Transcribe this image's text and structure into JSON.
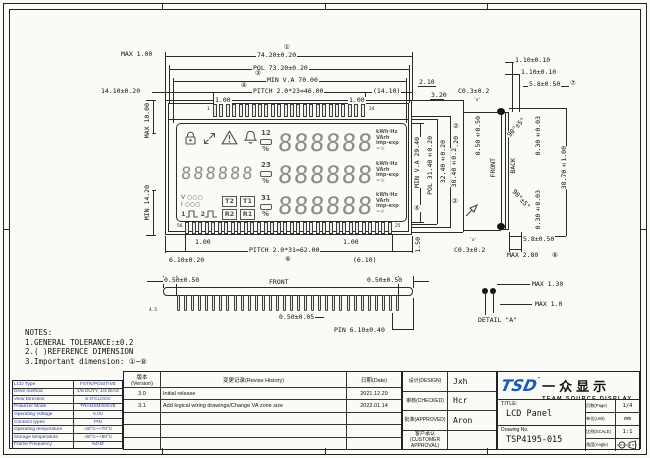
{
  "sheet": {
    "paper": "#fafaf7",
    "line": "#2a2a2a",
    "accent_blue": "#1a5cb5",
    "table_blue": "#2a3f9f"
  },
  "circles": {
    "c1": "①",
    "c2": "②",
    "c3": "③",
    "c4": "④",
    "c5": "⑤",
    "c6": "⑥",
    "c7": "⑦",
    "c8": "⑧"
  },
  "notes": {
    "lines": [
      "NOTES:",
      "1.GENERAL TOLERANCE:±0.2",
      "2.( )REFERENCE DIMENSION",
      "3.Important dimension: ①~⑧"
    ]
  },
  "top_view": {
    "dims": {
      "max_h": "MAX 1.00",
      "d74": "74.20±0.20",
      "pol73": "POL 73.20±0.20",
      "va70": "MIN V.A 70.00",
      "pitch46": "PITCH 2.0*23=46.00",
      "off1410": "14.10±0.20",
      "ref1410": "(14.10)",
      "g100a": "1.00",
      "g100b": "1.00",
      "m210": "2.10",
      "m320": "3.20",
      "max10": "MAX 10.00",
      "min142": "MIN 14.20",
      "va294": "MIN V.A 29.40",
      "pol314": "POL 31.40±0.20",
      "d324": "32.40±0.20",
      "d384": "38.40±0.20",
      "b100a": "1.00",
      "b100b": "1.00",
      "pitch62": "PITCH 2.0*31=62.00",
      "off610": "6.10±0.20",
      "ref610": "(6.10)",
      "m150": "1.50"
    },
    "pins": {
      "top_count": 24,
      "bottom_count": 32,
      "top_first": "1",
      "top_last": "24",
      "bottom_left": "56",
      "bottom_right": "25"
    }
  },
  "lcd": {
    "digits": "888888",
    "small_digits": "888888",
    "zones": [
      "12",
      "23",
      "31"
    ],
    "percent": "%",
    "boxes": [
      "T2",
      "T1",
      "R2",
      "R1"
    ],
    "left_legend": [
      "V ○○○",
      "I ○○○"
    ],
    "wave_labels": [
      "1",
      "2"
    ],
    "units_lines": [
      "kWh·Hz",
      "VArh",
      "imp-exp",
      "~☼"
    ]
  },
  "side_view": {
    "dims": {
      "t110a": "1.10±0.10",
      "t110b": "1.10±0.10",
      "t58": "5.8±0.50",
      "c03t": "C0.3±0.2",
      "xt": "'x'",
      "ang_t": "90°±5°",
      "v050": "0.50±0.50",
      "v030t": "0.30±0.03",
      "d384": "38.40±0.2",
      "d387": "38.70±1.00",
      "front": "FRONT",
      "back": "BACK",
      "ang_b": "90°±5°",
      "v030b": "0.30±0.03",
      "b58": "5.8±0.50",
      "max28": "MAX 2.80",
      "c03b": "C0.3±0.2",
      "xb": "'x'"
    }
  },
  "front_view": {
    "dims": {
      "l050": "0.50±0.50",
      "label": "FRONT",
      "r050": "0.50±0.50",
      "t005": "0.50±0.05",
      "pin610": "PIN 6.10±0.40",
      "a45": "4.5"
    },
    "pin_count": 32
  },
  "detail_a": {
    "max130": "MAX 1.30",
    "max10": "MAX 1.0",
    "label": "DETAIL \"A\""
  },
  "spec_table": {
    "rows": [
      [
        "LCD Type",
        "FSTN/POSITIVE"
      ],
      [
        "Drive method",
        "1/8 DUTY, 1/4 BIAS"
      ],
      [
        "View Direction",
        "6 O'CLOCK"
      ],
      [
        "Polarizer Mode",
        "TRANSMISSIVE"
      ],
      [
        "Operating Voltage",
        "5.0V"
      ],
      [
        "Connect types",
        "PIN"
      ],
      [
        "Operating temperature",
        "-20°C~+70°C"
      ],
      [
        "Storage temperature",
        "-30°C~+80°C"
      ],
      [
        "Frame Frequency",
        "64HZ"
      ]
    ]
  },
  "revision_table": {
    "headers": [
      "版本(Version)",
      "变更记录(Revise History)",
      "日期(Date)"
    ],
    "rows": [
      [
        "3.0",
        "Initial release",
        "2021.12.29"
      ],
      [
        "3.1",
        "Add logical wiring drawings/Change VA zone size",
        "2022.01.14"
      ],
      [
        "",
        "",
        ""
      ],
      [
        "",
        "",
        ""
      ],
      [
        "",
        "",
        ""
      ]
    ]
  },
  "signoff": {
    "rows": [
      [
        "设计(DESIGN)",
        "Jxh"
      ],
      [
        "审核(CHECKED)",
        "Hcr"
      ],
      [
        "批准(APPROVED)",
        "Aron"
      ],
      [
        "客户承认 (CUSTOMER APPROVAL)",
        ""
      ]
    ]
  },
  "title_block": {
    "logo": "TSD",
    "tm": "™",
    "logo_cn": "一众显示",
    "logo_en": "TEAM SOURCE DISPLAY",
    "title_label": "TITLE:",
    "title": "LCD Panel",
    "drawing_no_label": "Drawing No.",
    "drawing_no": "TSP4195-015",
    "meta": [
      [
        "页数(Page)",
        "1/4"
      ],
      [
        "单位(Unit)",
        "mm"
      ],
      [
        "比例(SCALE)",
        "1:1"
      ],
      [
        "角度(Angle)",
        "icon"
      ]
    ]
  }
}
